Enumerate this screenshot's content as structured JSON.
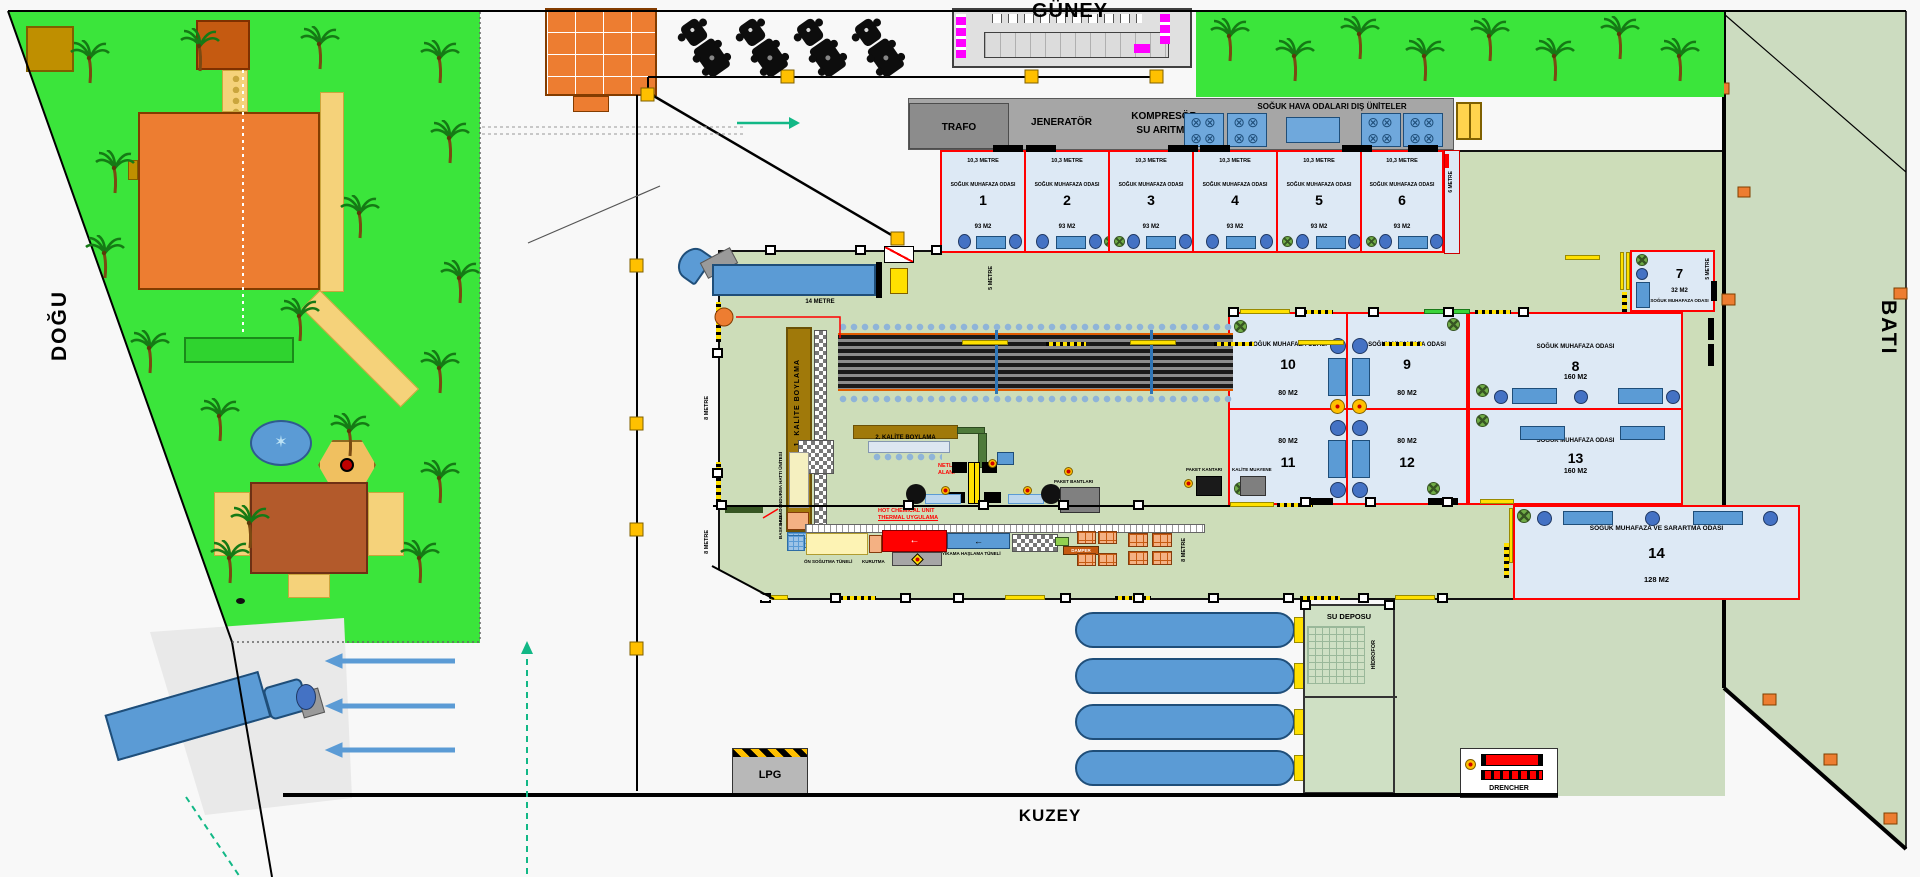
{
  "compass": {
    "south": "GÜNEY",
    "north": "KUZEY",
    "east": "DOĞU",
    "west": "BATI"
  },
  "utility": {
    "trafo": "TRAFO",
    "generator": "JENERATÖR",
    "compressor": "KOMPRESÖR",
    "water_treatment": "SU ARITMA",
    "outdoor_units": "SOĞUK HAVA ODALARI DIŞ ÜNİTELER"
  },
  "cold_rooms": [
    {
      "w": "10,3 METRE",
      "t": "SOĞUK MUHAFAZA ODASI",
      "n": "1",
      "a": "93 M2"
    },
    {
      "w": "10,3 METRE",
      "t": "SOĞUK MUHAFAZA ODASI",
      "n": "2",
      "a": "93 M2"
    },
    {
      "w": "10,3 METRE",
      "t": "SOĞUK MUHAFAZA ODASI",
      "n": "3",
      "a": "93 M2"
    },
    {
      "w": "10,3 METRE",
      "t": "SOĞUK MUHAFAZA ODASI",
      "n": "4",
      "a": "93 M2"
    },
    {
      "w": "10,3 METRE",
      "t": "SOĞUK MUHAFAZA ODASI",
      "n": "5",
      "a": "93 M2"
    },
    {
      "w": "10,3 METRE",
      "t": "SOĞUK MUHAFAZA ODASI",
      "n": "6",
      "a": "93 M2"
    }
  ],
  "corridor": {
    "right_of_room6": "6 METRE"
  },
  "room7": {
    "t": "SOĞUK MUHAFAZA ODASI",
    "n": "7",
    "a": "32 M2",
    "side": "5 METRE"
  },
  "room8": {
    "t": "SOĞUK MUHAFAZA ODASI",
    "n": "8",
    "a": "160 M2"
  },
  "room9": {
    "t": "SOĞUK MUHAFAZA ODASI",
    "n": "9",
    "a": "80 M2"
  },
  "room10": {
    "t": "SOĞUK MUHAFAZA ODASI",
    "n": "10",
    "a": "80 M2"
  },
  "room11": {
    "n": "11",
    "a": "80 M2"
  },
  "room12": {
    "n": "12",
    "a": "80 M2"
  },
  "room13": {
    "t": "SOĞUK MUHAFAZA ODASI",
    "n": "13",
    "a": "160 M2"
  },
  "room14": {
    "t": "SOĞUK MUHAFAZA VE SARARTMA ODASI",
    "n": "14",
    "a": "128 M2"
  },
  "process": {
    "kalite1": "1. KALİTE BOYLAMA",
    "kalite2": "2. KALİTE BOYLAMA",
    "netleme1": "NETLEME",
    "netleme2": "ALANI",
    "hot1": "HOT CHEMICAL UNIT",
    "hot2": "THERMAL UYGULAMA",
    "on_sogutma": "ÖN SOĞUTMA TÜNELİ",
    "kurutma": "KURUTMA",
    "yikama": "YIKAMA HAŞLAMA TÜNELİ",
    "damper": "DAMPER",
    "paket_bantlari": "PAKET BANTLARI",
    "paket_kantari": "PAKET KANTARI",
    "kalite_muayene": "KALİTE MUAYENE",
    "hizli_dondurma": "HIZLI DONDURMA HATTI ÜNİTESİ",
    "baskilama": "BASKILAMA"
  },
  "dimensions": {
    "dock": "14 METRE",
    "five_a": "5 METRE",
    "five_b": "5 METRE",
    "eight_a": "8 METRE",
    "eight_b": "8 METRE",
    "eight_c": "8 METRE"
  },
  "facilities": {
    "su_deposu": "SU DEPOSU",
    "hidrofor": "HİDROFOR",
    "lpg": "LPG",
    "drencher": "DRENCHER"
  },
  "icons": {
    "fan": "⊗⊗⊗⊗",
    "star": "✶"
  },
  "colors": {
    "lawn": "#3be53b",
    "hall_floor": "#cdddb9",
    "outdoor": "#ccdcc0",
    "room_fill": "#dde9f5",
    "room_border": "#ff0000",
    "machine_brown": "#a0790a",
    "equipment_blue": "#5b9bd5",
    "marker_yellow": "#ffc000",
    "building_orange": "#ed7d31"
  }
}
